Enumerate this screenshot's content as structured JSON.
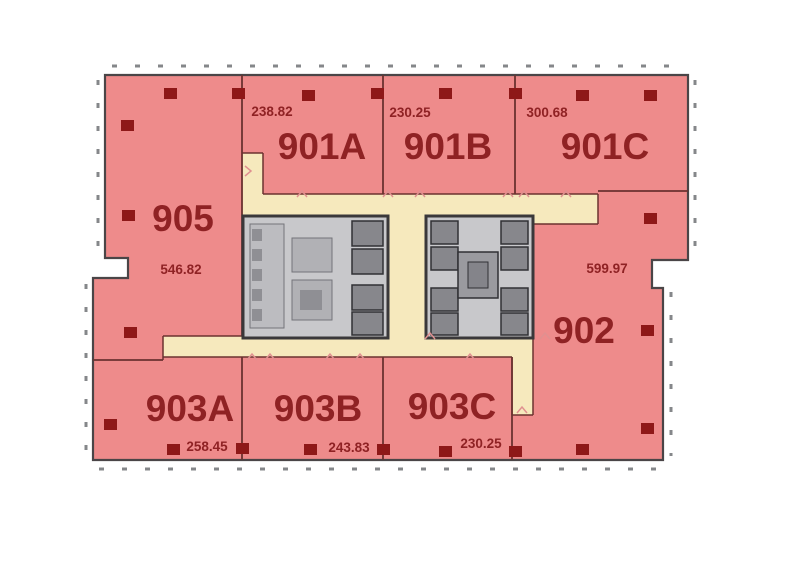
{
  "plan": {
    "type": "office-floor-plan",
    "units": [
      {
        "name": "905",
        "area": "546.82"
      },
      {
        "name": "901A",
        "area": "238.82"
      },
      {
        "name": "901B",
        "area": "230.25"
      },
      {
        "name": "901C",
        "area": "300.68"
      },
      {
        "name": "902",
        "area": "599.97"
      },
      {
        "name": "903A",
        "area": "258.45"
      },
      {
        "name": "903B",
        "area": "243.83"
      },
      {
        "name": "903C",
        "area": "230.25"
      }
    ],
    "colors": {
      "unit_fill": "#ee8b8b",
      "corridor_fill": "#f6e9bd",
      "wall": "#6b3230",
      "outer_wall": "#4a4547",
      "column": "#8e1818",
      "label_text": "#8f2224",
      "core_fill": "#c8c8cb",
      "core_wall": "#3a383a",
      "core_shaft": "#87878c",
      "facade_tick": "#85878a",
      "door_mark": "#e09090"
    }
  }
}
